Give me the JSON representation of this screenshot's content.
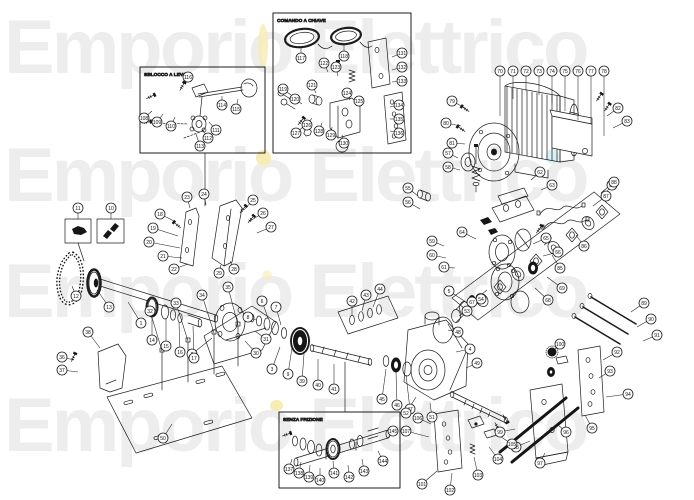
{
  "watermark": {
    "text": "Emporio Elettrico",
    "color": "#ededed",
    "accent_yellow": "#f6ecb4",
    "accent_cyan": "#d9f0f4"
  },
  "insets": [
    {
      "title": "SBLOCCO A LEVA"
    },
    {
      "title": "COMANDO A CHIAVE"
    },
    {
      "title": "SENZA FRIZIONE"
    }
  ],
  "balloons": [
    {
      "n": "1",
      "x": 141,
      "y": 323,
      "tx": 128,
      "ty": 302
    },
    {
      "n": "2",
      "x": 192,
      "y": 354,
      "tx": 212,
      "ty": 338
    },
    {
      "n": "3",
      "x": 272,
      "y": 369,
      "tx": 280,
      "ty": 347
    },
    {
      "n": "4",
      "x": 470,
      "y": 349,
      "tx": 456,
      "ty": 352
    },
    {
      "n": "5",
      "x": 449,
      "y": 291,
      "tx": 466,
      "ty": 302
    },
    {
      "n": "6",
      "x": 262,
      "y": 301,
      "tx": 268,
      "ty": 318
    },
    {
      "n": "7",
      "x": 276,
      "y": 307,
      "tx": 281,
      "ty": 325
    },
    {
      "n": "8",
      "x": 248,
      "y": 317,
      "tx": 256,
      "ty": 320
    },
    {
      "n": "9",
      "x": 288,
      "y": 374,
      "tx": 292,
      "ty": 348
    },
    {
      "n": "10",
      "x": 111,
      "y": 208,
      "tx": 111,
      "ty": 219
    },
    {
      "n": "11",
      "x": 78,
      "y": 208,
      "tx": 78,
      "ty": 219
    },
    {
      "n": "12",
      "x": 76,
      "y": 296,
      "tx": 72,
      "ty": 286
    },
    {
      "n": "13",
      "x": 109,
      "y": 307,
      "tx": 97,
      "ty": 290
    },
    {
      "n": "14",
      "x": 152,
      "y": 340,
      "tx": 152,
      "ty": 314
    },
    {
      "n": "15",
      "x": 166,
      "y": 346,
      "tx": 166,
      "ty": 318
    },
    {
      "n": "16",
      "x": 180,
      "y": 352,
      "tx": 179,
      "ty": 322
    },
    {
      "n": "17",
      "x": 194,
      "y": 358,
      "tx": 193,
      "ty": 326
    },
    {
      "n": "18",
      "x": 160,
      "y": 214,
      "tx": 176,
      "ty": 222
    },
    {
      "n": "19",
      "x": 153,
      "y": 228,
      "tx": 178,
      "ty": 236
    },
    {
      "n": "20",
      "x": 149,
      "y": 242,
      "tx": 180,
      "ty": 248
    },
    {
      "n": "21",
      "x": 163,
      "y": 256,
      "tx": 182,
      "ty": 258
    },
    {
      "n": "22",
      "x": 174,
      "y": 269,
      "tx": 188,
      "ty": 264
    },
    {
      "n": "23",
      "x": 187,
      "y": 197,
      "tx": 190,
      "ty": 208
    },
    {
      "n": "24",
      "x": 204,
      "y": 194,
      "tx": 206,
      "ty": 205
    },
    {
      "n": "25",
      "x": 253,
      "y": 200,
      "tx": 244,
      "ty": 210
    },
    {
      "n": "26",
      "x": 263,
      "y": 213,
      "tx": 250,
      "ty": 221
    },
    {
      "n": "27",
      "x": 271,
      "y": 227,
      "tx": 257,
      "ty": 233
    },
    {
      "n": "28",
      "x": 234,
      "y": 269,
      "tx": 230,
      "ty": 261
    },
    {
      "n": "29",
      "x": 219,
      "y": 273,
      "tx": 221,
      "ty": 265
    },
    {
      "n": "30",
      "x": 256,
      "y": 353,
      "tx": 245,
      "ty": 341
    },
    {
      "n": "31",
      "x": 266,
      "y": 339,
      "tx": 255,
      "ty": 331
    },
    {
      "n": "32",
      "x": 150,
      "y": 311,
      "tx": 162,
      "ty": 351
    },
    {
      "n": "33",
      "x": 176,
      "y": 303,
      "tx": 188,
      "ty": 341
    },
    {
      "n": "34",
      "x": 202,
      "y": 295,
      "tx": 214,
      "ty": 333
    },
    {
      "n": "35",
      "x": 228,
      "y": 287,
      "tx": 238,
      "ty": 325
    },
    {
      "n": "36",
      "x": 62,
      "y": 357,
      "tx": 74,
      "ty": 360
    },
    {
      "n": "37",
      "x": 62,
      "y": 370,
      "tx": 78,
      "ty": 372
    },
    {
      "n": "38",
      "x": 88,
      "y": 332,
      "tx": 100,
      "ty": 348
    },
    {
      "n": "39",
      "x": 302,
      "y": 381,
      "tx": 304,
      "ty": 354
    },
    {
      "n": "40",
      "x": 318,
      "y": 385,
      "tx": 318,
      "ty": 359
    },
    {
      "n": "41",
      "x": 334,
      "y": 389,
      "tx": 334,
      "ty": 364
    },
    {
      "n": "42",
      "x": 352,
      "y": 301,
      "tx": 352,
      "ty": 316
    },
    {
      "n": "43",
      "x": 366,
      "y": 295,
      "tx": 362,
      "ty": 311
    },
    {
      "n": "44",
      "x": 380,
      "y": 289,
      "tx": 373,
      "ty": 307
    },
    {
      "n": "45",
      "x": 382,
      "y": 399,
      "tx": 386,
      "ty": 369
    },
    {
      "n": "46",
      "x": 397,
      "y": 405,
      "tx": 396,
      "ty": 372
    },
    {
      "n": "47",
      "x": 410,
      "y": 409,
      "tx": 406,
      "ty": 375
    },
    {
      "n": "48",
      "x": 458,
      "y": 332,
      "tx": 448,
      "ty": 330
    },
    {
      "n": "49",
      "x": 477,
      "y": 363,
      "tx": 466,
      "ty": 368
    },
    {
      "n": "50",
      "x": 163,
      "y": 438,
      "tx": 172,
      "ty": 424
    },
    {
      "n": "51",
      "x": 432,
      "y": 417,
      "tx": 430,
      "ty": 403
    },
    {
      "n": "52",
      "x": 406,
      "y": 413,
      "tx": 416,
      "ty": 397
    },
    {
      "n": "53",
      "x": 467,
      "y": 311,
      "tx": 459,
      "ty": 316
    },
    {
      "n": "54",
      "x": 481,
      "y": 299,
      "tx": 472,
      "ty": 306
    },
    {
      "n": "55",
      "x": 408,
      "y": 188,
      "tx": 418,
      "ty": 196
    },
    {
      "n": "56",
      "x": 408,
      "y": 202,
      "tx": 420,
      "ty": 209
    },
    {
      "n": "57",
      "x": 448,
      "y": 153,
      "tx": 458,
      "ty": 158
    },
    {
      "n": "58",
      "x": 448,
      "y": 167,
      "tx": 460,
      "ty": 170
    },
    {
      "n": "59",
      "x": 432,
      "y": 241,
      "tx": 444,
      "ty": 246
    },
    {
      "n": "60",
      "x": 432,
      "y": 255,
      "tx": 446,
      "ty": 258
    },
    {
      "n": "61",
      "x": 444,
      "y": 267,
      "tx": 455,
      "ty": 268
    },
    {
      "n": "62",
      "x": 540,
      "y": 172,
      "tx": 531,
      "ty": 180
    },
    {
      "n": "63",
      "x": 552,
      "y": 185,
      "tx": 541,
      "ty": 190
    },
    {
      "n": "64",
      "x": 462,
      "y": 232,
      "tx": 476,
      "ty": 239
    },
    {
      "n": "65",
      "x": 546,
      "y": 238,
      "tx": 533,
      "ty": 244
    },
    {
      "n": "66",
      "x": 558,
      "y": 252,
      "tx": 543,
      "ty": 256
    },
    {
      "n": "67",
      "x": 472,
      "y": 302,
      "tx": 487,
      "ty": 290
    },
    {
      "n": "68",
      "x": 548,
      "y": 300,
      "tx": 535,
      "ty": 288
    },
    {
      "n": "69",
      "x": 562,
      "y": 288,
      "tx": 547,
      "ty": 277
    },
    {
      "n": "70",
      "x": 500,
      "y": 71,
      "tx": 500,
      "ty": 116
    },
    {
      "n": "71",
      "x": 513,
      "y": 71,
      "tx": 513,
      "ty": 99
    },
    {
      "n": "72",
      "x": 526,
      "y": 71,
      "tx": 526,
      "ty": 91
    },
    {
      "n": "73",
      "x": 539,
      "y": 71,
      "tx": 539,
      "ty": 95
    },
    {
      "n": "74",
      "x": 552,
      "y": 71,
      "tx": 552,
      "ty": 103
    },
    {
      "n": "75",
      "x": 565,
      "y": 71,
      "tx": 565,
      "ty": 111
    },
    {
      "n": "76",
      "x": 578,
      "y": 71,
      "tx": 578,
      "ty": 120
    },
    {
      "n": "77",
      "x": 591,
      "y": 71,
      "tx": 591,
      "ty": 124
    },
    {
      "n": "78",
      "x": 604,
      "y": 71,
      "tx": 604,
      "ty": 136
    },
    {
      "n": "79",
      "x": 452,
      "y": 101,
      "tx": 465,
      "ty": 108
    },
    {
      "n": "80",
      "x": 446,
      "y": 123,
      "tx": 461,
      "ty": 126
    },
    {
      "n": "81",
      "x": 452,
      "y": 143,
      "tx": 465,
      "ty": 144
    },
    {
      "n": "82",
      "x": 618,
      "y": 108,
      "tx": 607,
      "ty": 116
    },
    {
      "n": "83",
      "x": 627,
      "y": 121,
      "tx": 613,
      "ty": 128
    },
    {
      "n": "84",
      "x": 612,
      "y": 185,
      "tx": 601,
      "ty": 199
    },
    {
      "n": "85",
      "x": 560,
      "y": 268,
      "tx": 552,
      "ty": 255
    },
    {
      "n": "86",
      "x": 584,
      "y": 246,
      "tx": 576,
      "ty": 235
    },
    {
      "n": "87",
      "x": 606,
      "y": 196,
      "tx": 593,
      "ty": 206
    },
    {
      "n": "88",
      "x": 614,
      "y": 182,
      "tx": 601,
      "ty": 193
    },
    {
      "n": "89",
      "x": 644,
      "y": 303,
      "tx": 631,
      "ty": 312
    },
    {
      "n": "90",
      "x": 651,
      "y": 319,
      "tx": 637,
      "ty": 327
    },
    {
      "n": "91",
      "x": 657,
      "y": 335,
      "tx": 643,
      "ty": 341
    },
    {
      "n": "92",
      "x": 617,
      "y": 352,
      "tx": 603,
      "ty": 360
    },
    {
      "n": "93",
      "x": 610,
      "y": 371,
      "tx": 599,
      "ty": 378
    },
    {
      "n": "94",
      "x": 628,
      "y": 394,
      "tx": 606,
      "ty": 397
    },
    {
      "n": "95",
      "x": 592,
      "y": 428,
      "tx": 585,
      "ty": 415
    },
    {
      "n": "96",
      "x": 566,
      "y": 432,
      "tx": 557,
      "ty": 424
    },
    {
      "n": "97",
      "x": 540,
      "y": 463,
      "tx": 545,
      "ty": 453
    },
    {
      "n": "98",
      "x": 516,
      "y": 447,
      "tx": 530,
      "ty": 441
    },
    {
      "n": "99",
      "x": 500,
      "y": 432,
      "tx": 515,
      "ty": 429
    },
    {
      "n": "100",
      "x": 560,
      "y": 344,
      "tx": 553,
      "ty": 351
    },
    {
      "n": "101",
      "x": 422,
      "y": 484,
      "tx": 437,
      "ty": 471
    },
    {
      "n": "102",
      "x": 450,
      "y": 490,
      "tx": 452,
      "ty": 473
    },
    {
      "n": "103",
      "x": 478,
      "y": 475,
      "tx": 474,
      "ty": 457
    },
    {
      "n": "104",
      "x": 498,
      "y": 459,
      "tx": 489,
      "ty": 447
    },
    {
      "n": "105",
      "x": 512,
      "y": 444,
      "tx": 501,
      "ty": 437
    },
    {
      "n": "106",
      "x": 418,
      "y": 418,
      "tx": 431,
      "ty": 424
    },
    {
      "n": "107",
      "x": 406,
      "y": 431,
      "tx": 429,
      "ty": 437
    },
    {
      "n": "108",
      "x": 144,
      "y": 118,
      "tx": 152,
      "ty": 111
    },
    {
      "n": "109",
      "x": 157,
      "y": 122,
      "tx": 163,
      "ty": 114
    },
    {
      "n": "110",
      "x": 171,
      "y": 126,
      "tx": 175,
      "ty": 117
    },
    {
      "n": "111",
      "x": 216,
      "y": 130,
      "tx": 209,
      "ty": 122
    },
    {
      "n": "112",
      "x": 208,
      "y": 138,
      "tx": 202,
      "ty": 129
    },
    {
      "n": "113",
      "x": 200,
      "y": 146,
      "tx": 196,
      "ty": 134
    },
    {
      "n": "114",
      "x": 222,
      "y": 105,
      "tx": 222,
      "ty": 96
    },
    {
      "n": "115",
      "x": 236,
      "y": 109,
      "tx": 238,
      "ty": 99
    },
    {
      "n": "116",
      "x": 188,
      "y": 77,
      "tx": 183,
      "ty": 84
    },
    {
      "n": "117",
      "x": 301,
      "y": 58,
      "tx": 301,
      "ty": 47
    },
    {
      "n": "118",
      "x": 344,
      "y": 56,
      "tx": 344,
      "ty": 45
    },
    {
      "n": "119",
      "x": 283,
      "y": 89,
      "tx": 291,
      "ty": 95
    },
    {
      "n": "120",
      "x": 295,
      "y": 99,
      "tx": 302,
      "ty": 104
    },
    {
      "n": "121",
      "x": 312,
      "y": 85,
      "tx": 316,
      "ty": 93
    },
    {
      "n": "122",
      "x": 324,
      "y": 63,
      "tx": 328,
      "ty": 72
    },
    {
      "n": "123",
      "x": 336,
      "y": 67,
      "tx": 338,
      "ty": 76
    },
    {
      "n": "124",
      "x": 347,
      "y": 93,
      "tx": 350,
      "ty": 100
    },
    {
      "n": "125",
      "x": 359,
      "y": 101,
      "tx": 360,
      "ty": 107
    },
    {
      "n": "126",
      "x": 307,
      "y": 125,
      "tx": 312,
      "ty": 118
    },
    {
      "n": "127",
      "x": 296,
      "y": 133,
      "tx": 303,
      "ty": 127
    },
    {
      "n": "128",
      "x": 319,
      "y": 131,
      "tx": 322,
      "ty": 123
    },
    {
      "n": "129",
      "x": 331,
      "y": 135,
      "tx": 332,
      "ty": 127
    },
    {
      "n": "130",
      "x": 344,
      "y": 143,
      "tx": 342,
      "ty": 135
    },
    {
      "n": "131",
      "x": 402,
      "y": 53,
      "tx": 392,
      "ty": 57
    },
    {
      "n": "132",
      "x": 402,
      "y": 67,
      "tx": 392,
      "ty": 70
    },
    {
      "n": "133",
      "x": 402,
      "y": 81,
      "tx": 392,
      "ty": 82
    },
    {
      "n": "134",
      "x": 399,
      "y": 105,
      "tx": 390,
      "ty": 107
    },
    {
      "n": "135",
      "x": 399,
      "y": 119,
      "tx": 390,
      "ty": 119
    },
    {
      "n": "136",
      "x": 399,
      "y": 133,
      "tx": 390,
      "ty": 131
    },
    {
      "n": "137",
      "x": 289,
      "y": 469,
      "tx": 292,
      "ty": 459
    },
    {
      "n": "138",
      "x": 299,
      "y": 473,
      "tx": 301,
      "ty": 462
    },
    {
      "n": "139",
      "x": 309,
      "y": 477,
      "tx": 310,
      "ty": 465
    },
    {
      "n": "140",
      "x": 320,
      "y": 480,
      "tx": 320,
      "ty": 468
    },
    {
      "n": "141",
      "x": 334,
      "y": 473,
      "tx": 333,
      "ty": 461
    },
    {
      "n": "142",
      "x": 349,
      "y": 477,
      "tx": 348,
      "ty": 465
    },
    {
      "n": "143",
      "x": 364,
      "y": 471,
      "tx": 362,
      "ty": 459
    },
    {
      "n": "144",
      "x": 383,
      "y": 461,
      "tx": 378,
      "ty": 451
    },
    {
      "n": "145",
      "x": 393,
      "y": 431,
      "tx": 388,
      "ty": 438
    }
  ]
}
